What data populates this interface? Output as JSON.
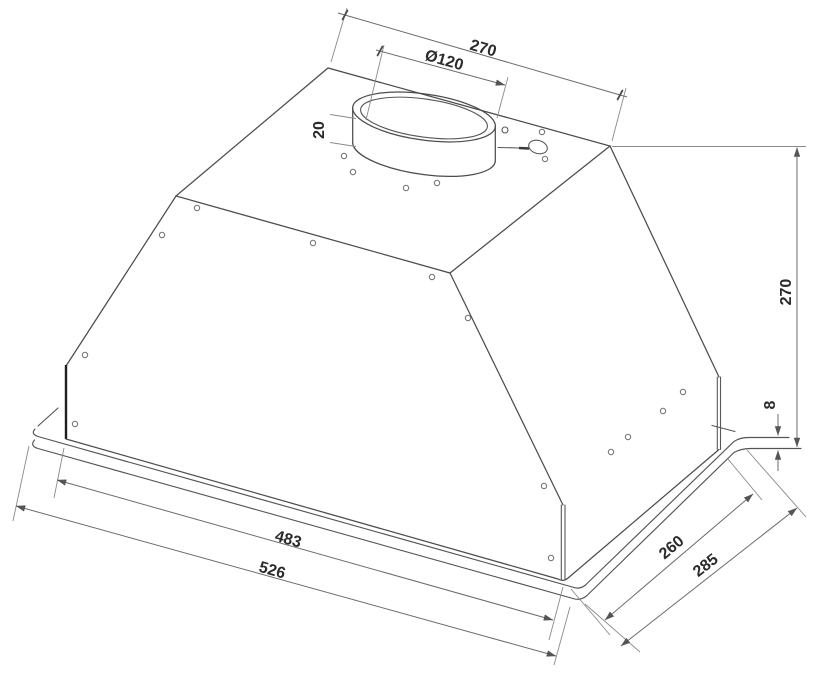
{
  "drawing": {
    "description": "isometric technical drawing of built-in cooker hood with dimensions",
    "dimensions": {
      "top_edge": "270",
      "duct_diameter": "Ø120",
      "duct_collar_height": "20",
      "body_height": "270",
      "flange_height": "8",
      "body_width": "483",
      "overall_width": "526",
      "body_depth": "260",
      "overall_depth": "285"
    },
    "colors": {
      "background": "#ffffff",
      "outline": "#4d4d4d",
      "bold_edge": "#1f1f1f",
      "dimension_line": "#6b6b6b",
      "extension_line": "#8a8a8a",
      "text": "#2b2b2b"
    }
  }
}
